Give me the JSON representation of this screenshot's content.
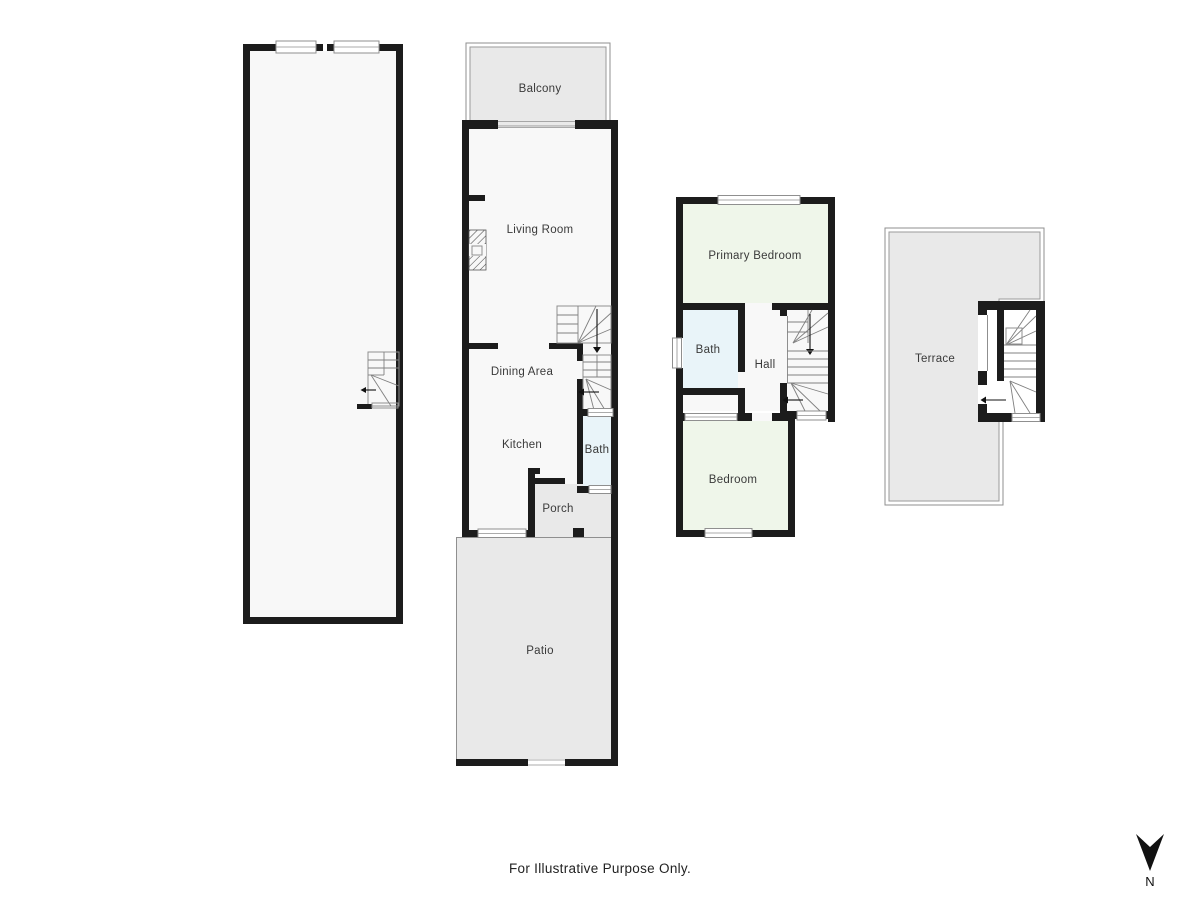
{
  "labels": {
    "balcony": "Balcony",
    "living_room": "Living Room",
    "dining_area": "Dining Area",
    "kitchen": "Kitchen",
    "bath_main": "Bath",
    "porch": "Porch",
    "patio": "Patio",
    "primary_bedroom": "Primary Bedroom",
    "bath_upper": "Bath",
    "hall": "Hall",
    "bedroom": "Bedroom",
    "terrace": "Terrace"
  },
  "footer": {
    "disclaimer": "For Illustrative Purpose Only."
  },
  "compass": {
    "north": "N"
  },
  "colors": {
    "wall": "#1c1c1c",
    "room": "#f8f8f8",
    "outdoor": "#e9e9e9",
    "bath": "#e9f4f9",
    "bedroom": "#eff6ea",
    "line": "#8f8f8f",
    "text": "#3a3a3a"
  }
}
